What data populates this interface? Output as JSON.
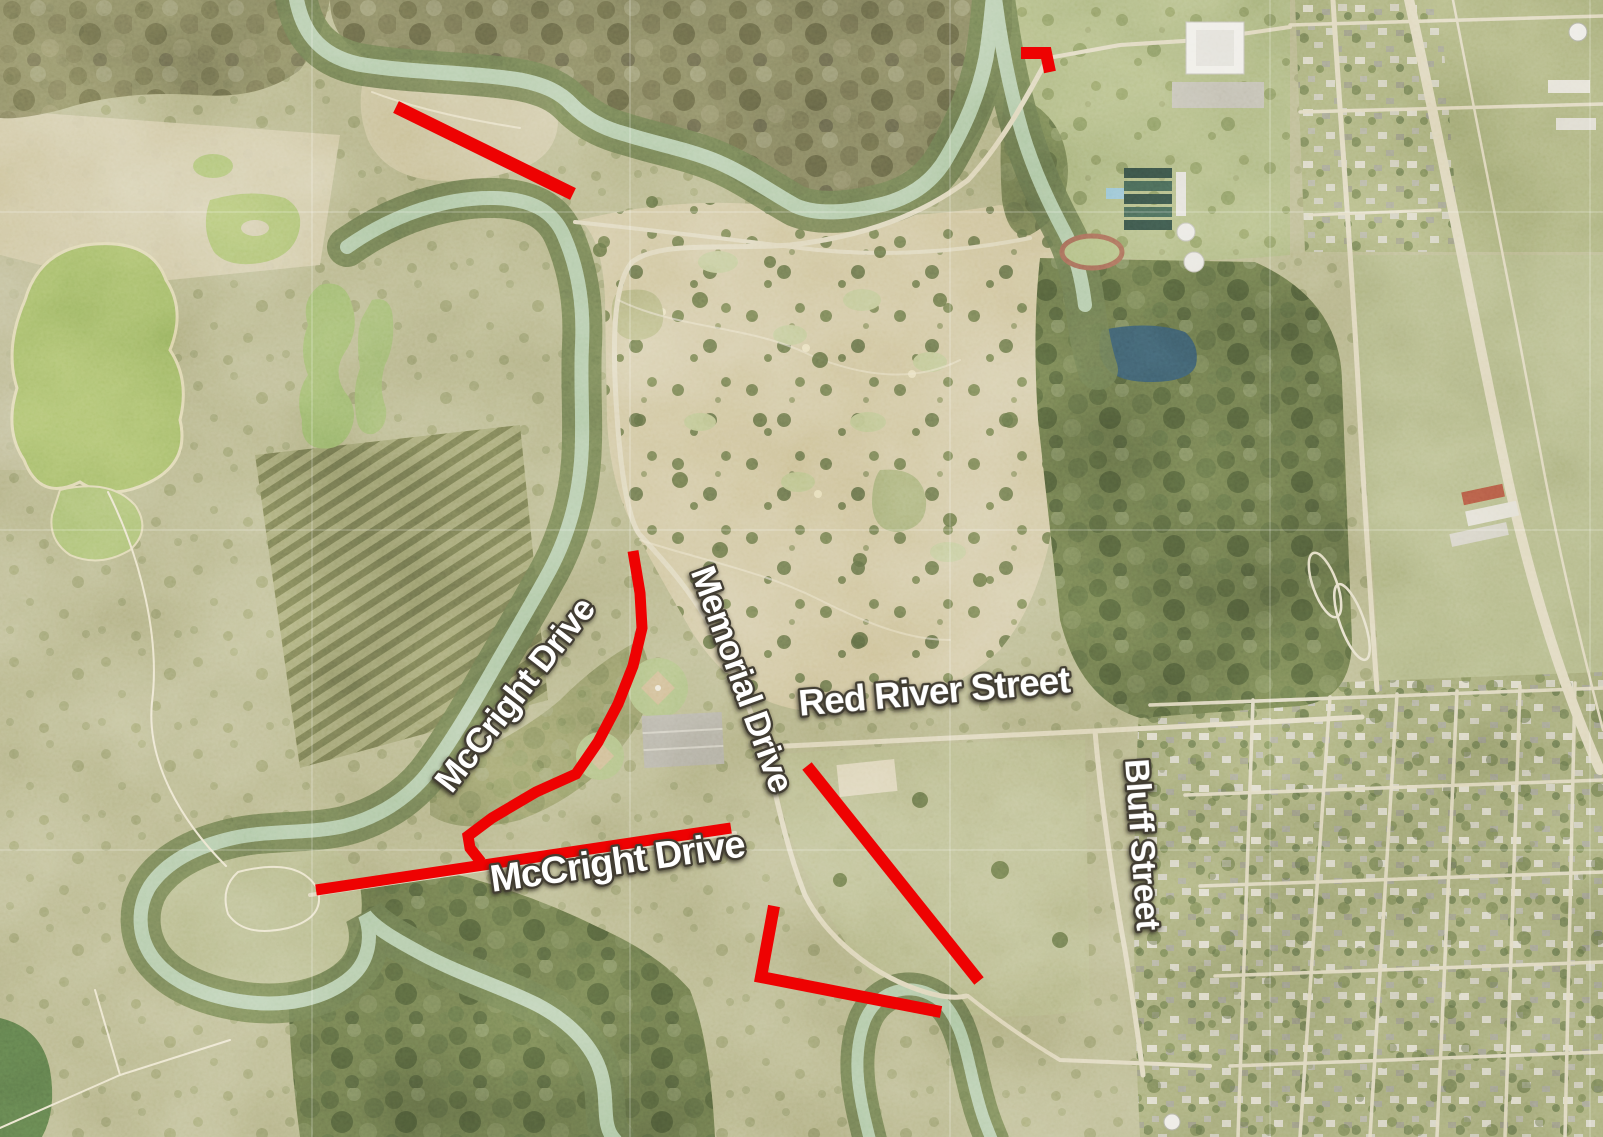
{
  "map": {
    "title": "Aerial map with street annotations",
    "colors": {
      "annotation_red": "#ee0202",
      "label_fill": "#ffffff",
      "label_outline": "#423e33"
    },
    "labels": [
      {
        "id": "mccright-drive-upper",
        "text": "McCright Drive",
        "x": 524,
        "y": 702,
        "rotation": -52,
        "size": 35
      },
      {
        "id": "memorial-drive",
        "text": "Memorial Drive",
        "x": 731,
        "y": 683,
        "rotation": 70,
        "size": 35
      },
      {
        "id": "red-river-street",
        "text": "Red River Street",
        "x": 935,
        "y": 704,
        "rotation": -5,
        "size": 37
      },
      {
        "id": "bluff-street",
        "text": "Bluff Street",
        "x": 1131,
        "y": 845,
        "rotation": 86,
        "size": 34
      },
      {
        "id": "mccright-drive-lower",
        "text": "McCright Drive",
        "x": 619,
        "y": 874,
        "rotation": -8,
        "size": 38
      }
    ],
    "annotations": {
      "stroke_width": 11,
      "polylines": [
        {
          "id": "northwest-segment",
          "width": 13,
          "points": [
            [
              396,
              107
            ],
            [
              573,
              194
            ]
          ]
        },
        {
          "id": "northeast-elbow",
          "width": 12,
          "points": [
            [
              1021,
              53
            ],
            [
              1046,
              53
            ],
            [
              1050,
              72
            ]
          ]
        },
        {
          "id": "mccright-curve",
          "width": 11,
          "points": [
            [
              633,
              551
            ],
            [
              640,
              593
            ],
            [
              642,
              628
            ],
            [
              633,
              666
            ],
            [
              618,
              704
            ],
            [
              598,
              742
            ],
            [
              576,
              774
            ],
            [
              536,
              792
            ],
            [
              492,
              818
            ],
            [
              468,
              836
            ],
            [
              470,
              848
            ],
            [
              481,
              862
            ]
          ]
        },
        {
          "id": "mccright-straight",
          "width": 11,
          "points": [
            [
              316,
              890
            ],
            [
              731,
              828
            ]
          ]
        },
        {
          "id": "red-river-diagonal",
          "width": 12,
          "points": [
            [
              807,
              766
            ],
            [
              979,
              981
            ]
          ]
        },
        {
          "id": "south-elbow",
          "width": 12,
          "points": [
            [
              774,
              906
            ],
            [
              761,
              977
            ],
            [
              941,
              1012
            ]
          ]
        }
      ]
    },
    "gridlines": {
      "vertical_x": [
        312,
        630,
        950,
        1270,
        1590
      ],
      "horizontal_y": [
        212,
        530,
        850,
        1168
      ]
    }
  }
}
